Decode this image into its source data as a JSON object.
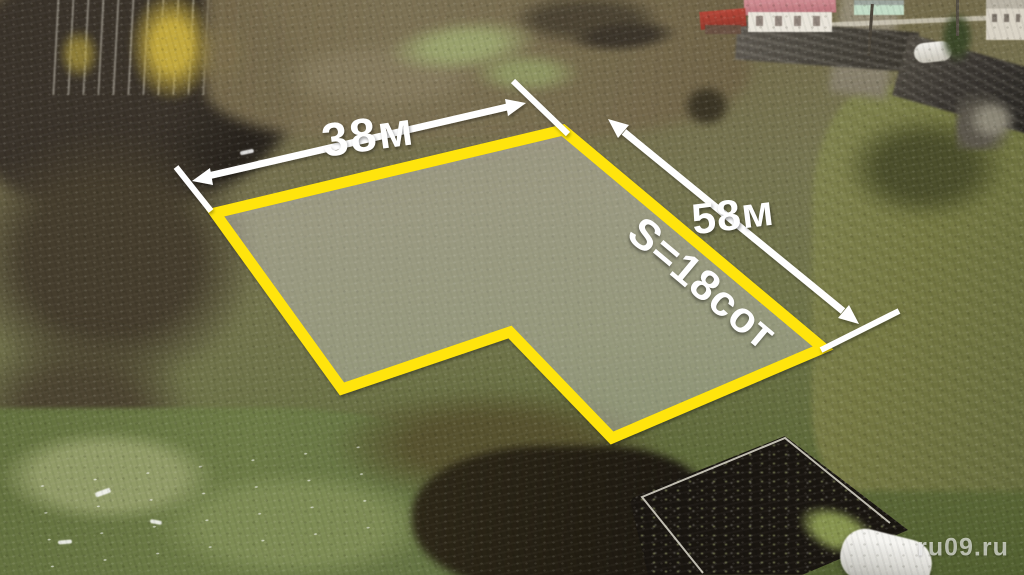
{
  "annotations": {
    "width_label": "38м",
    "length_label": "58м",
    "area_label": "S=18сот",
    "line_color": "#ffffff"
  },
  "plot_outline": {
    "vertices": "215,213 563,130 823,348 612,438 510,332 342,389",
    "outline_color": "#ffe408",
    "fill_color": "rgba(255,255,255,0.26)"
  },
  "watermark": {
    "text": "ru09.ru"
  }
}
